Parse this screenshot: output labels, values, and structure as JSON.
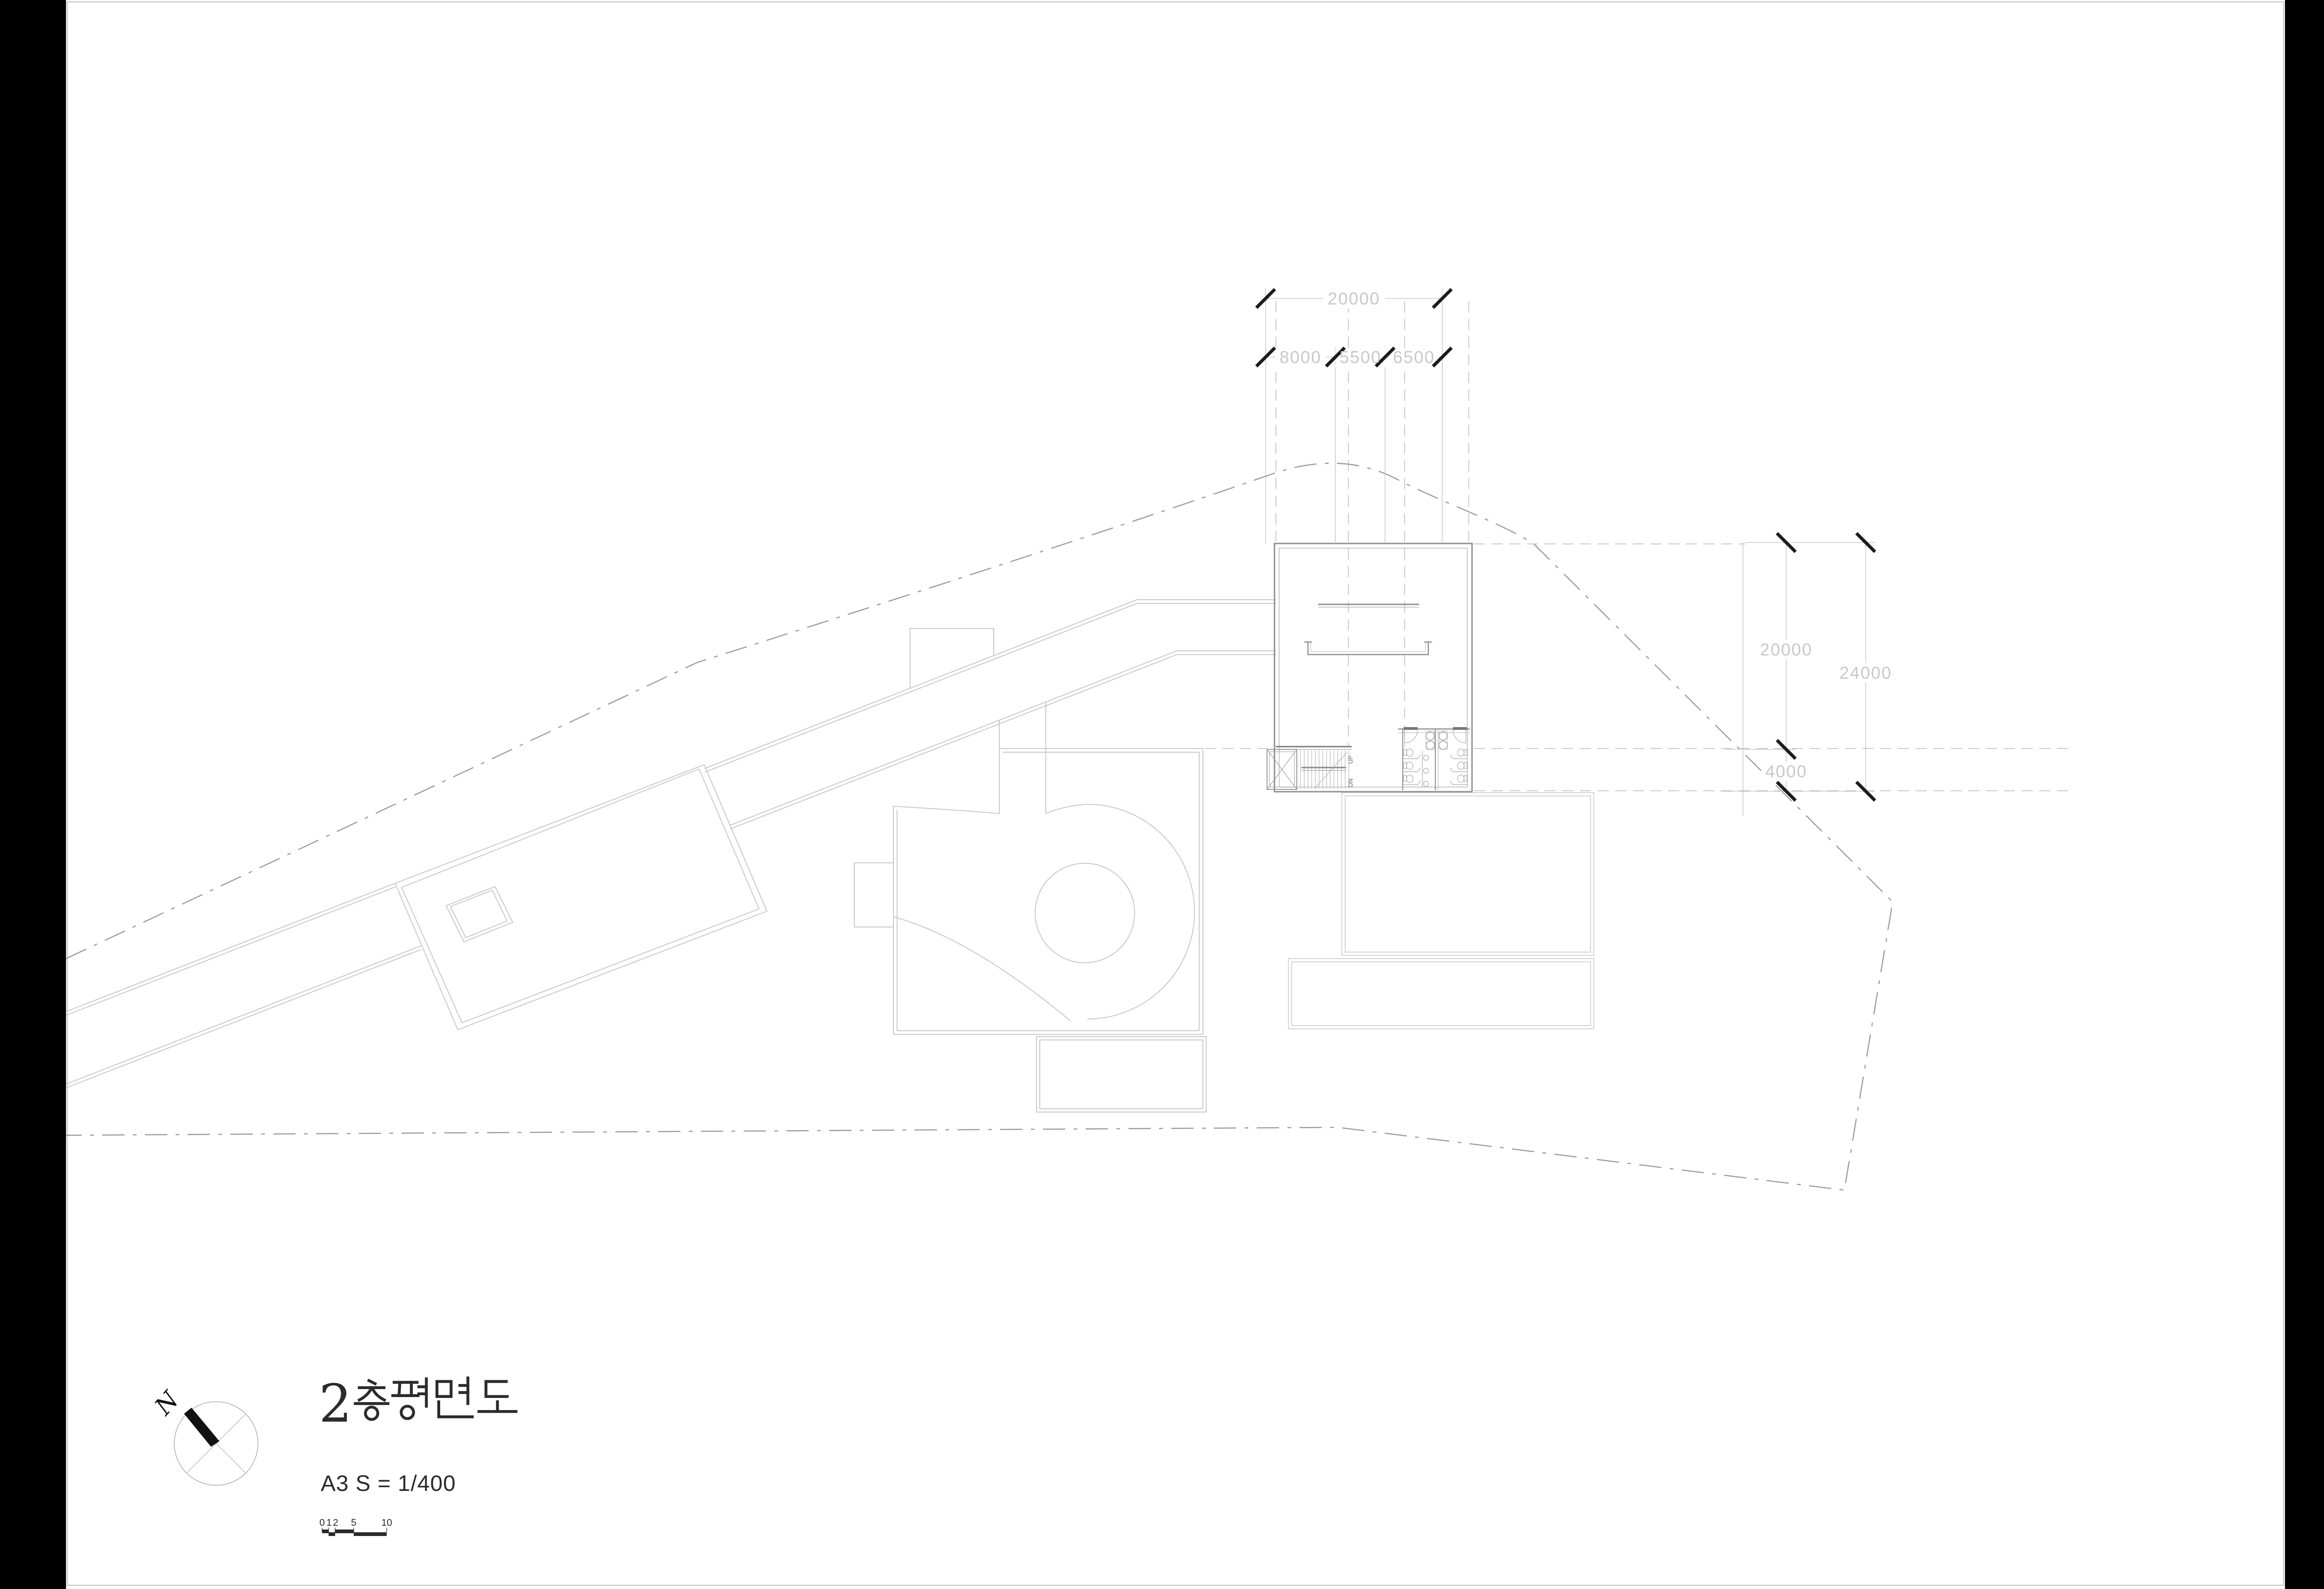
{
  "title": {
    "text": "2층 평면도",
    "leading_numeral": "2",
    "hangul": "층 평면도"
  },
  "subtitle": {
    "text": "A3  S = 1/400"
  },
  "north_indicator": {
    "label": "N"
  },
  "scale_bar": {
    "tick_labels": [
      "0",
      "1",
      "2",
      "5",
      "10"
    ]
  },
  "dimensions": {
    "top_total": "20000",
    "top_segments": [
      "8000",
      "5500",
      "6500"
    ],
    "right_inner": [
      "20000",
      "4000"
    ],
    "right_total": "24000"
  },
  "stairs": {
    "up": "UP",
    "down": "DN"
  },
  "colors": {
    "paper": "#ffffff",
    "letterbox": "#000000",
    "wall": "#8f8f8f",
    "light_outline": "#c9c9c9",
    "faint_outline": "#d4d4d4",
    "dimension_text": "#c8c8c8",
    "tick": "#1c1c1c",
    "site_boundary": "#9a9a9a",
    "ink": "#2b2b2b"
  }
}
